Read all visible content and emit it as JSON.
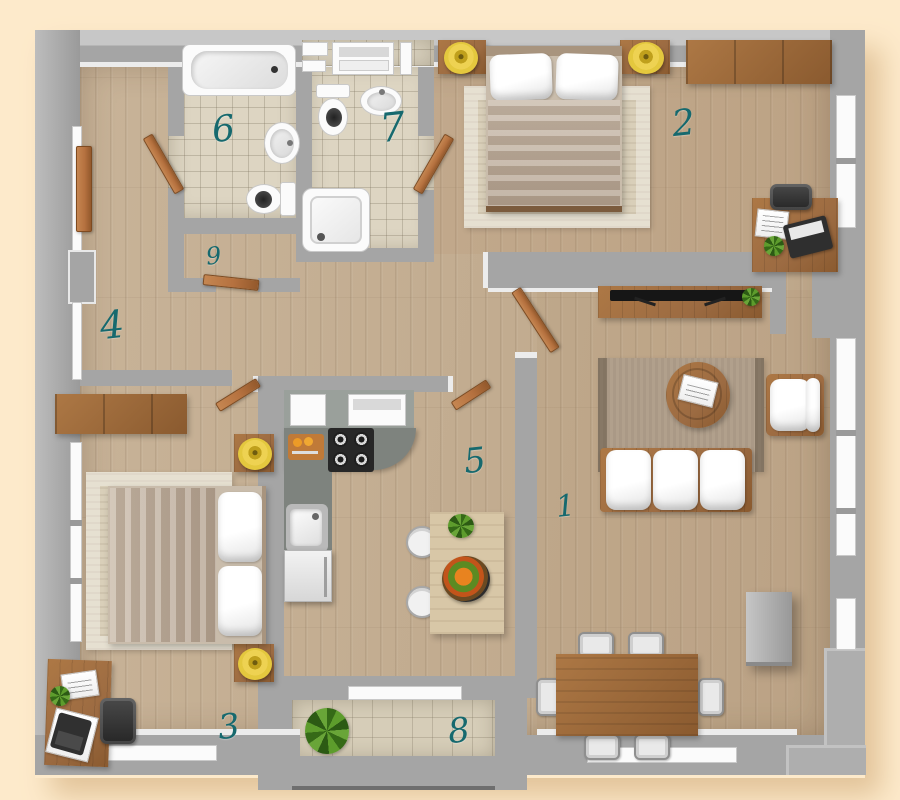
{
  "plan": {
    "kind": "apartment-floor-plan",
    "room_count": 9
  },
  "rooms": [
    {
      "label": "1"
    },
    {
      "label": "2"
    },
    {
      "label": "3"
    },
    {
      "label": "4"
    },
    {
      "label": "5"
    },
    {
      "label": "6"
    },
    {
      "label": "7"
    },
    {
      "label": "8"
    },
    {
      "label": "9"
    }
  ],
  "colors": {
    "background": "#fdeacb",
    "shadow": "#e2c49a",
    "wall": "#a5a5a5",
    "wall_light": "#c7c7c7",
    "floor_wood": "#c8b398",
    "floor_tile": "#ddd5c2",
    "balcony_tile": "#d6cdb8",
    "label": "#16696e",
    "door": "#b5713f",
    "furniture_wood": "#9c6b42",
    "pouf_yellow": "#e4c83e",
    "counter": "#7e837e",
    "rug": "#d9cfb9",
    "fixture_white": "#fbfbfb"
  }
}
